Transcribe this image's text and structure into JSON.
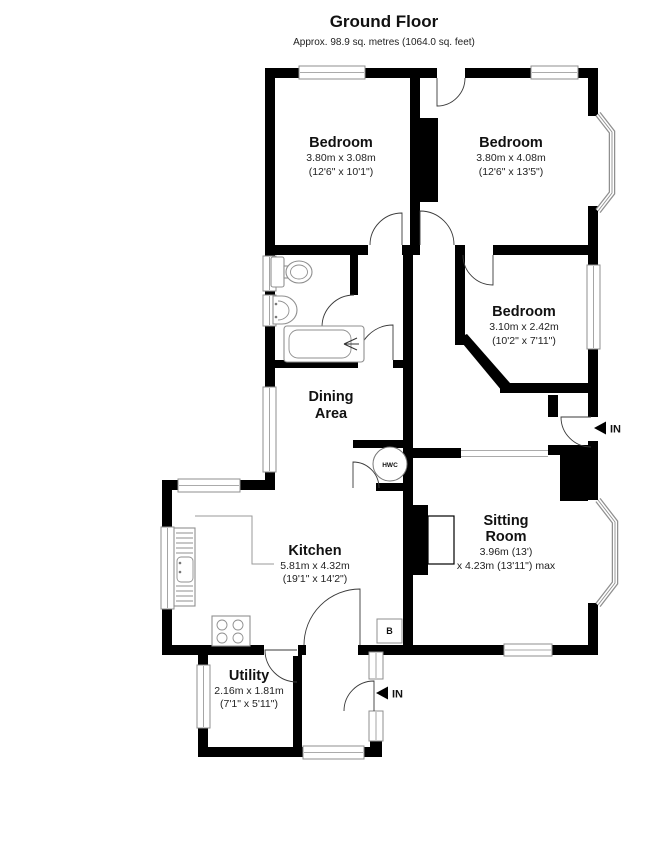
{
  "title": "Ground Floor",
  "subtitle": "Approx. 98.9 sq. metres (1064.0 sq. feet)",
  "rooms": {
    "bedroom1": {
      "name": "Bedroom",
      "metric": "3.80m x 3.08m",
      "imperial": "(12'6\" x 10'1\")"
    },
    "bedroom2": {
      "name": "Bedroom",
      "metric": "3.80m x 4.08m",
      "imperial": "(12'6\" x 13'5\")"
    },
    "bedroom3": {
      "name": "Bedroom",
      "metric": "3.10m x 2.42m",
      "imperial": "(10'2\" x 7'11\")"
    },
    "dining": {
      "line1": "Dining",
      "line2": "Area"
    },
    "sitting": {
      "line1": "Sitting",
      "line2": "Room",
      "metric": "3.96m (13')",
      "imperial": "x 4.23m (13'11\") max"
    },
    "kitchen": {
      "name": "Kitchen",
      "metric": "5.81m x 4.32m",
      "imperial": "(19'1\" x 14'2\")"
    },
    "utility": {
      "name": "Utility",
      "metric": "2.16m x 1.81m",
      "imperial": "(7'1\" x 5'11\")"
    }
  },
  "annotations": {
    "entrance_side": "IN",
    "entrance_rear": "IN",
    "hot_water_cylinder": "HWC",
    "boiler": "B"
  },
  "colors": {
    "wall": "#000000",
    "window_frame": "#8f8f8f",
    "background": "#ffffff",
    "text": "#111111"
  }
}
